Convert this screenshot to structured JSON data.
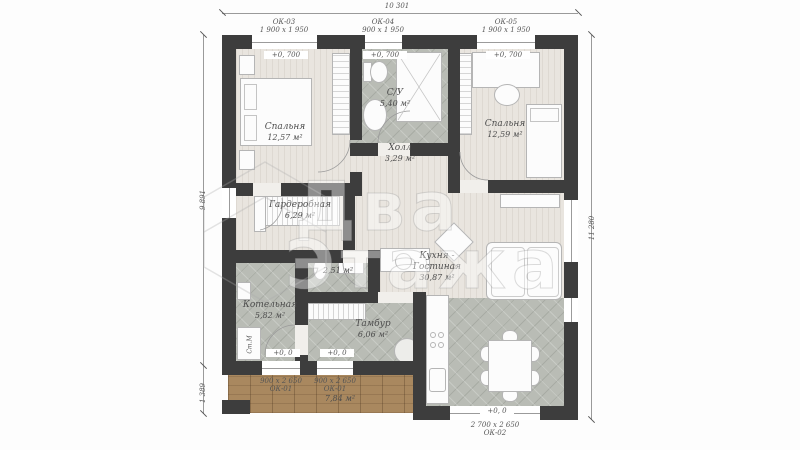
{
  "dimensions": {
    "width_total": "10 301",
    "height_main": "9 891",
    "height_terrace": "1 389",
    "height_right": "11 280"
  },
  "openings": {
    "ok03": {
      "id": "ОК-03",
      "size": "1 900 x 1 950",
      "level": "+0, 700"
    },
    "ok04": {
      "id": "ОК-04",
      "size": "900 x 1 950",
      "level": "+0, 700"
    },
    "ok05": {
      "id": "ОК-05",
      "size": "1 900 x 1 950",
      "level": "+0, 700"
    },
    "ok01": {
      "id": "ОК-01",
      "size": "900 x 2 650",
      "level": "+0, 0"
    },
    "ok02": {
      "id": "ОК-02",
      "size": "2 700 x 2 650",
      "level": "+0, 0"
    }
  },
  "rooms": {
    "bedroom_left": {
      "name": "Спальня",
      "area": "12,57 м²"
    },
    "bathroom": {
      "name": "С/У",
      "area": "5,40 м²"
    },
    "hall": {
      "name": "Холл",
      "area": "3,29 м²"
    },
    "bedroom_right": {
      "name": "Спальня",
      "area": "12,59 м²"
    },
    "wardrobe": {
      "name": "Гардеробная",
      "area": "6,29 м²"
    },
    "kitchen_living": {
      "name_line1": "Кухня -",
      "name_line2": "Гостиная",
      "area": "30,87 м²"
    },
    "boiler": {
      "name": "Котельная",
      "area": "5,82 м²"
    },
    "wc": {
      "area": "2,51 м²"
    },
    "vestibule": {
      "name": "Тамбур",
      "area": "6,06 м²"
    },
    "terrace": {
      "area": "7,84 м²"
    }
  },
  "annotations": {
    "washing_machine": "Ст.М"
  },
  "watermark": {
    "line1": "Два",
    "line2": "Этажа"
  },
  "colors": {
    "wall": "#3d3d3d",
    "wood_floor": "#e9e5df",
    "tile_floor": "#b9bcb5",
    "deck": "#a9885f"
  }
}
